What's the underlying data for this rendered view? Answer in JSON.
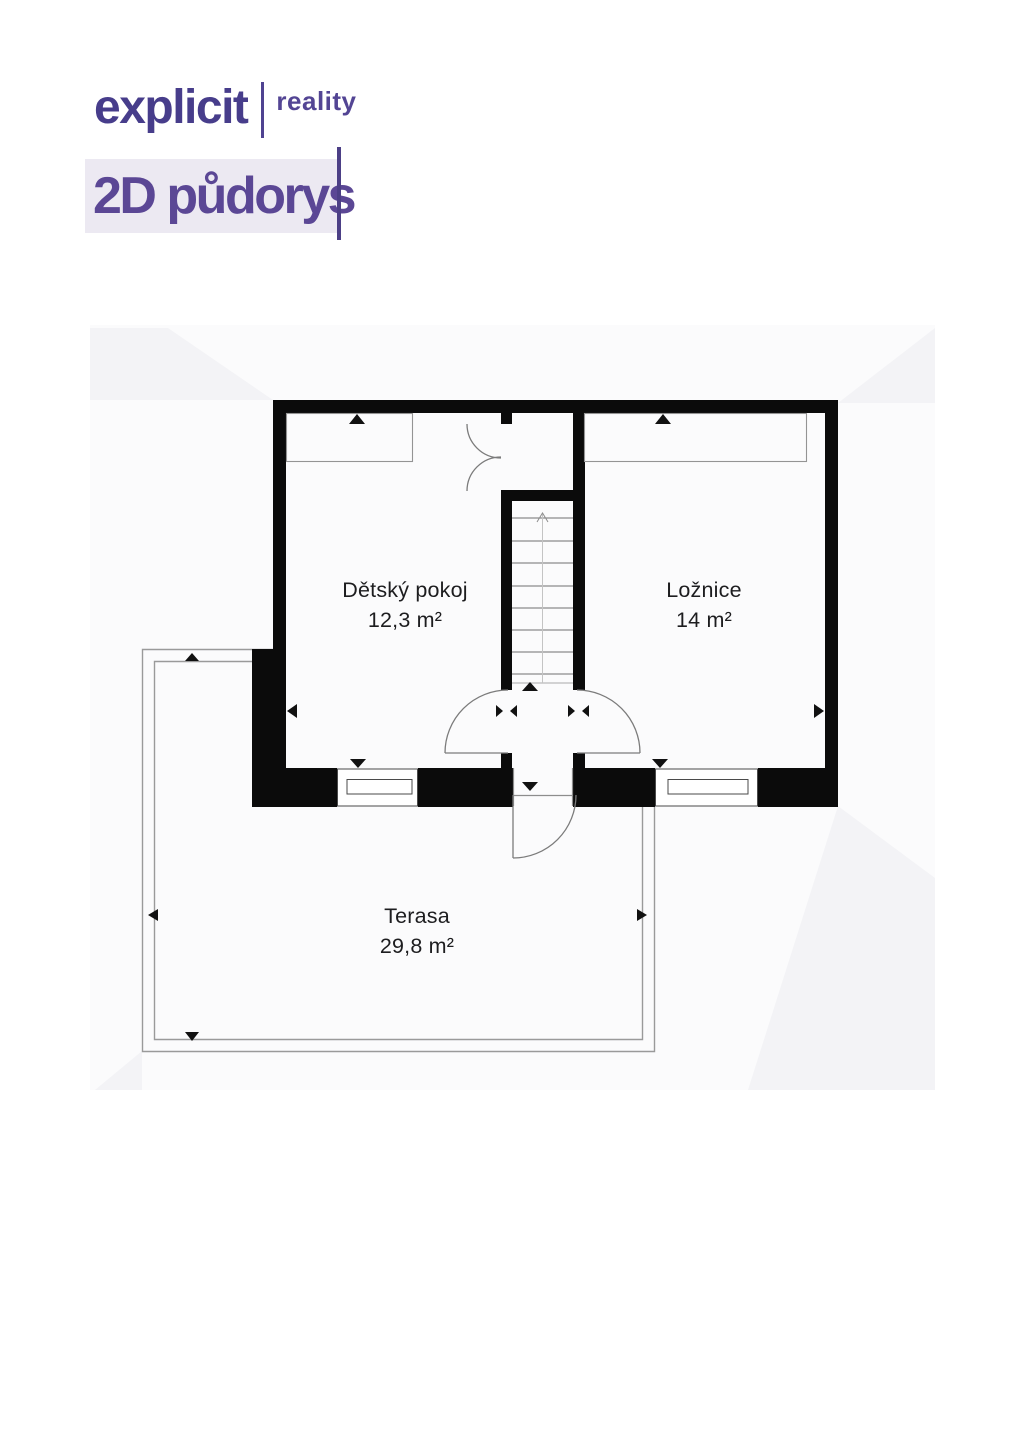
{
  "brand": {
    "logo_primary": "explicit",
    "logo_secondary": "reality",
    "logo_color": "#473d8b",
    "logo_secondary_color": "#534594"
  },
  "header": {
    "title": "2D půdorys",
    "title_color": "#5b4795",
    "title_background": "#ece9f2",
    "cursor_color": "#4c3f86"
  },
  "floorplan": {
    "wall_color": "#0b0b0b",
    "thin_line_color": "#8d8d8d",
    "rooms": [
      {
        "name": "Dětský pokoj",
        "area": "12,3 m²"
      },
      {
        "name": "Ložnice",
        "area": "14 m²"
      },
      {
        "name": "Terasa",
        "area": "29,8 m²"
      }
    ],
    "features": [
      "staircase",
      "double-closet-door",
      "room-doors",
      "terrace-door",
      "window-left",
      "window-right",
      "terrace-railing"
    ]
  }
}
